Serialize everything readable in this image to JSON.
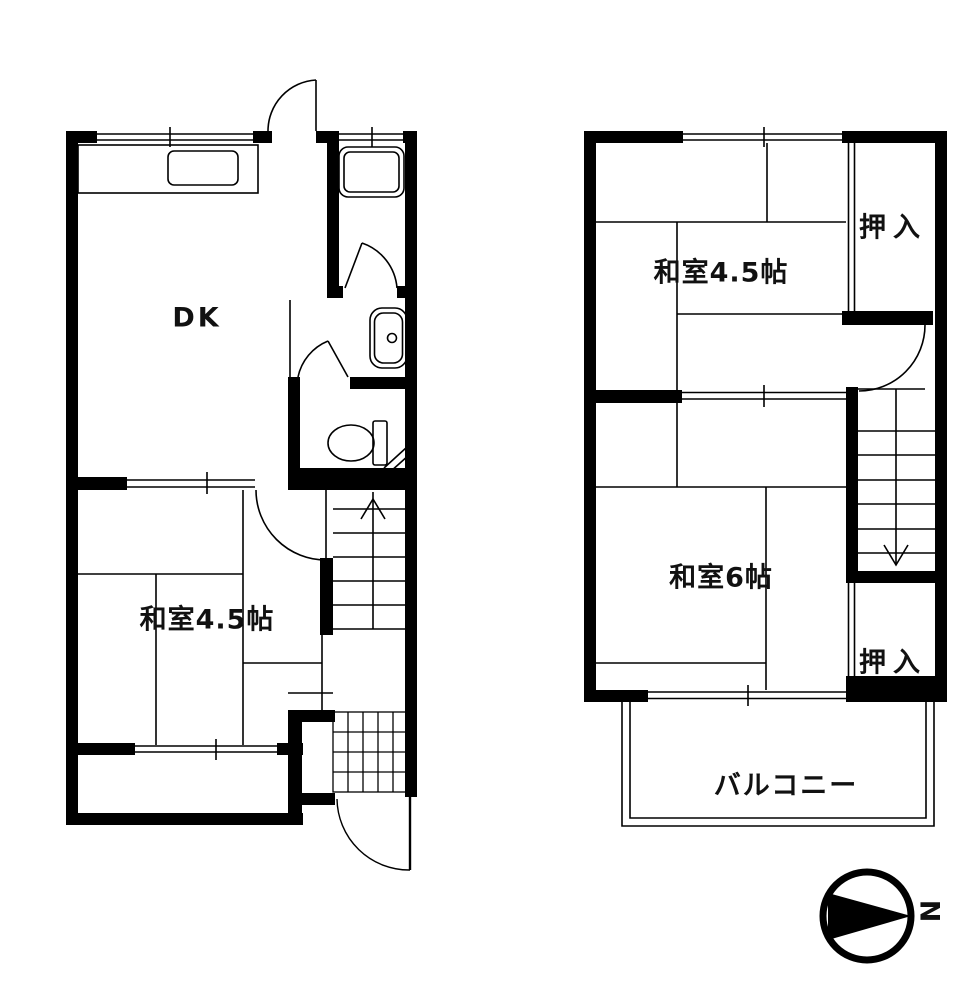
{
  "plan": {
    "first_floor": {
      "dk_label": "DK",
      "washitsu_45_label": "和室4.5帖"
    },
    "second_floor": {
      "washitsu_45_label": "和室4.5帖",
      "washitsu_6_label": "和室6帖",
      "closet_top_label": "押入",
      "closet_bottom_label": "押入",
      "balcony_label": "バルコニー"
    },
    "compass": {
      "north_label": "N"
    }
  },
  "colors": {
    "background": "#ffffff",
    "line": "#000000",
    "text": "#111111"
  }
}
